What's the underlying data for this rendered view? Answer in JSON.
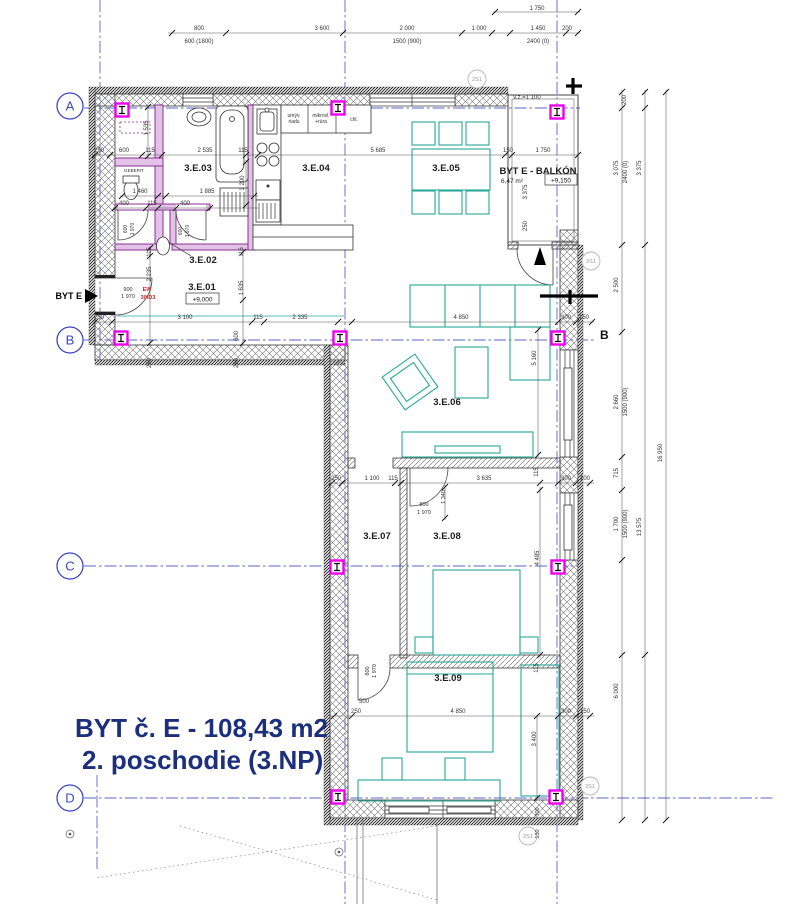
{
  "title": {
    "line1": "BYT č. E  - 108,43 m2",
    "line2": "2. poschodie  (3.NP)"
  },
  "grid": {
    "rows": [
      {
        "label": "A"
      },
      {
        "label": "B"
      },
      {
        "label": "C"
      },
      {
        "label": "D"
      }
    ]
  },
  "rooms": [
    {
      "id": "3.E.01",
      "elevation": "+9,000"
    },
    {
      "id": "3.E.02"
    },
    {
      "id": "3.E.03"
    },
    {
      "id": "3.E.04"
    },
    {
      "id": "3.E.05"
    },
    {
      "id": "3.E.06"
    },
    {
      "id": "3.E.07"
    },
    {
      "id": "3.E.08"
    },
    {
      "id": "3.E.09"
    },
    {
      "id": "BYT E - BALKÓN",
      "area": "6,47 m²",
      "elevation": "+9,150"
    }
  ],
  "markers": {
    "entry_label": "BYT E",
    "section_label": "B",
    "detail_label": "2S1",
    "balcony_note": "v.z.=1 100",
    "fire_rating": [
      "EW",
      "30/D3"
    ],
    "axis_markers": [
      {
        "x": 122,
        "y": 110
      },
      {
        "x": 338,
        "y": 108
      },
      {
        "x": 557,
        "y": 112
      },
      {
        "x": 121,
        "y": 338
      },
      {
        "x": 340,
        "y": 338
      },
      {
        "x": 558,
        "y": 338
      },
      {
        "x": 337,
        "y": 567
      },
      {
        "x": 558,
        "y": 567
      },
      {
        "x": 338,
        "y": 797
      },
      {
        "x": 556,
        "y": 797
      }
    ]
  },
  "colors": {
    "grid": "#3b49c0",
    "furniture": "#2aa79b",
    "marker": "#ee00ee",
    "plumb": "#8a3191",
    "title": "#1b2f7d",
    "fire": "#cc2222"
  },
  "annotations": [
    {
      "n": "dim-top-800",
      "t": "800",
      "x": 199,
      "y": 30
    },
    {
      "n": "dim-top-600-1800",
      "t": "600 (1800)",
      "x": 199,
      "y": 43
    },
    {
      "n": "dim-top-3600",
      "t": "3 600",
      "x": 322,
      "y": 30
    },
    {
      "n": "dim-top-2000",
      "t": "2 000",
      "x": 407,
      "y": 30
    },
    {
      "n": "dim-top-1500-900",
      "t": "1500 (900)",
      "x": 407,
      "y": 43
    },
    {
      "n": "dim-top-1000",
      "t": "1 000",
      "x": 479,
      "y": 30
    },
    {
      "n": "dim-top-1450",
      "t": "1 450",
      "x": 538,
      "y": 30
    },
    {
      "n": "dim-top-2400-0",
      "t": "2400 (0)",
      "x": 538,
      "y": 43
    },
    {
      "n": "dim-top-200",
      "t": "200",
      "x": 567,
      "y": 30
    },
    {
      "n": "dim-top-1750",
      "t": "1 750",
      "x": 537,
      "y": 10
    },
    {
      "n": "dim-bath-250",
      "t": "250",
      "x": 99,
      "y": 152
    },
    {
      "n": "dim-bath-600",
      "t": "600",
      "x": 124,
      "y": 152
    },
    {
      "n": "dim-bath-115a",
      "t": "115",
      "x": 150,
      "y": 152
    },
    {
      "n": "dim-bath-2535",
      "t": "2 535",
      "x": 205,
      "y": 152
    },
    {
      "n": "dim-bath-115b",
      "t": "115",
      "x": 243,
      "y": 152
    },
    {
      "n": "dim-bath-1535",
      "t": "1 535",
      "x": 148,
      "y": 128,
      "r": -90
    },
    {
      "n": "dim-bath-3200",
      "t": "3 200",
      "x": 244,
      "y": 183,
      "r": -90
    },
    {
      "n": "dim-wc-1460",
      "t": "1 460",
      "x": 140,
      "y": 193
    },
    {
      "n": "dim-bath-1885",
      "t": "1 885",
      "x": 207,
      "y": 193
    },
    {
      "n": "dim-wc-400a",
      "t": "400",
      "x": 124,
      "y": 205
    },
    {
      "n": "dim-wc-115",
      "t": "115",
      "x": 152,
      "y": 205
    },
    {
      "n": "dim-wc-400b",
      "t": "400",
      "x": 185,
      "y": 205
    },
    {
      "n": "dim-door-wc-600",
      "t": "600",
      "x": 127,
      "y": 229,
      "r": -90,
      "s": 5
    },
    {
      "n": "dim-door-wc-1970",
      "t": "1 970",
      "x": 134,
      "y": 229,
      "r": -90,
      "s": 5
    },
    {
      "n": "dim-door-302-600",
      "t": "600",
      "x": 182,
      "y": 231,
      "r": -90,
      "s": 5
    },
    {
      "n": "dim-door-302-1970",
      "t": "1 970",
      "x": 189,
      "y": 231,
      "r": -90,
      "s": 5
    },
    {
      "n": "dim-hall-115",
      "t": "115",
      "x": 151,
      "y": 252,
      "r": -90
    },
    {
      "n": "dim-hall-2235",
      "t": "2 235",
      "x": 151,
      "y": 274,
      "r": -90
    },
    {
      "n": "dim-hall-115b",
      "t": "115",
      "x": 243,
      "y": 252,
      "r": -90
    },
    {
      "n": "dim-hall-1635",
      "t": "1 635",
      "x": 243,
      "y": 288,
      "r": -90
    },
    {
      "n": "dim-entry-900",
      "t": "900",
      "x": 128,
      "y": 291,
      "s": 5.5
    },
    {
      "n": "dim-entry-1970",
      "t": "1 970",
      "x": 128,
      "y": 298,
      "s": 5.5
    },
    {
      "n": "fire-ew",
      "t": "EW",
      "x": 147,
      "y": 291,
      "s": 5.5,
      "c": "#cc2222",
      "b": true
    },
    {
      "n": "fire-30d3",
      "t": "30/D3",
      "x": 148,
      "y": 299,
      "s": 5.5,
      "c": "#cc2222",
      "b": true
    },
    {
      "n": "dim-b-250",
      "t": "250",
      "x": 99,
      "y": 319
    },
    {
      "n": "dim-b-3100",
      "t": "3 100",
      "x": 185,
      "y": 319
    },
    {
      "n": "dim-b-115",
      "t": "115",
      "x": 258,
      "y": 319
    },
    {
      "n": "dim-b-2335",
      "t": "2 335",
      "x": 300,
      "y": 319
    },
    {
      "n": "dim-b-4850",
      "t": "4 850",
      "x": 461,
      "y": 319
    },
    {
      "n": "dim-b-300",
      "t": "300",
      "x": 566,
      "y": 319
    },
    {
      "n": "dim-b-150",
      "t": "150",
      "x": 584,
      "y": 319
    },
    {
      "n": "dim-b-250v",
      "t": "250",
      "x": 151,
      "y": 363,
      "r": -90
    },
    {
      "n": "dim-b-600v",
      "t": "600",
      "x": 238,
      "y": 336,
      "r": -90
    },
    {
      "n": "dim-b-250v2",
      "t": "250",
      "x": 238,
      "y": 363,
      "r": -90
    },
    {
      "n": "dim-kit-5685",
      "t": "5 685",
      "x": 378,
      "y": 152
    },
    {
      "n": "dim-balc-150",
      "t": "150",
      "x": 508,
      "y": 152
    },
    {
      "n": "dim-balc-1750",
      "t": "1 750",
      "x": 543,
      "y": 152
    },
    {
      "n": "dim-balc-3375",
      "t": "3 375",
      "x": 527,
      "y": 192,
      "r": -90
    },
    {
      "n": "dim-balc-250",
      "t": "250",
      "x": 527,
      "y": 226,
      "r": -90
    },
    {
      "n": "dim-liv-5160",
      "t": "5 160",
      "x": 536,
      "y": 358,
      "r": -90
    },
    {
      "n": "dim-c-250",
      "t": "250",
      "x": 336,
      "y": 480
    },
    {
      "n": "dim-c-1100",
      "t": "1 100",
      "x": 372,
      "y": 480
    },
    {
      "n": "dim-c-115a",
      "t": "115",
      "x": 393,
      "y": 480
    },
    {
      "n": "dim-c-3635",
      "t": "3 635",
      "x": 484,
      "y": 480
    },
    {
      "n": "dim-c-115v",
      "t": "115",
      "x": 538,
      "y": 472,
      "r": -90
    },
    {
      "n": "dim-c-300",
      "t": "300",
      "x": 566,
      "y": 480
    },
    {
      "n": "dim-c-100",
      "t": "100",
      "x": 585,
      "y": 480
    },
    {
      "n": "dim-door308-800",
      "t": "800",
      "x": 424,
      "y": 506,
      "s": 5.5
    },
    {
      "n": "dim-door308-1970",
      "t": "1 970",
      "x": 424,
      "y": 514,
      "s": 5.5
    },
    {
      "n": "dim-door308-1340",
      "t": "1 340",
      "x": 445,
      "y": 497,
      "r": -90,
      "s": 5.5
    },
    {
      "n": "dim-308-4485",
      "t": "4 485",
      "x": 539,
      "y": 558,
      "r": -90
    },
    {
      "n": "dim-door309-800",
      "t": "800",
      "x": 369,
      "y": 671,
      "r": -90,
      "s": 5.5
    },
    {
      "n": "dim-door309-1970",
      "t": "1 970",
      "x": 376,
      "y": 671,
      "r": -90,
      "s": 5.5
    },
    {
      "n": "dim-309-500",
      "t": "500",
      "x": 364,
      "y": 703
    },
    {
      "n": "dim-309-115",
      "t": "115",
      "x": 538,
      "y": 668,
      "r": -90
    },
    {
      "n": "dim-d-250",
      "t": "250",
      "x": 356,
      "y": 713
    },
    {
      "n": "dim-d-4850",
      "t": "4 850",
      "x": 458,
      "y": 713
    },
    {
      "n": "dim-d-300",
      "t": "300",
      "x": 566,
      "y": 713
    },
    {
      "n": "dim-d-150",
      "t": "150",
      "x": 585,
      "y": 713
    },
    {
      "n": "dim-309-3400",
      "t": "3 400",
      "x": 536,
      "y": 739,
      "r": -90
    },
    {
      "n": "dim-dr-300",
      "t": "300",
      "x": 539,
      "y": 812,
      "r": -90,
      "s": 5.5
    },
    {
      "n": "dim-dr-150",
      "t": "150",
      "x": 539,
      "y": 834,
      "r": -90,
      "s": 5.5
    },
    {
      "n": "dim-r-200",
      "t": "200",
      "x": 626,
      "y": 100,
      "r": -90
    },
    {
      "n": "dim-r-3075",
      "t": "3 075",
      "x": 618,
      "y": 168,
      "r": -90
    },
    {
      "n": "dim-r-2400-0",
      "t": "2400 (0)",
      "x": 627,
      "y": 172,
      "r": -90
    },
    {
      "n": "dim-r-3375",
      "t": "3 375",
      "x": 641,
      "y": 168,
      "r": -90
    },
    {
      "n": "dim-r-2500",
      "t": "2 500",
      "x": 618,
      "y": 285,
      "r": -90
    },
    {
      "n": "dim-r-2660",
      "t": "2 660",
      "x": 618,
      "y": 402,
      "r": -90
    },
    {
      "n": "dim-r-1500-900a",
      "t": "1500 (900)",
      "x": 627,
      "y": 402,
      "r": -90
    },
    {
      "n": "dim-r-16950",
      "t": "16 950",
      "x": 662,
      "y": 453,
      "r": -90
    },
    {
      "n": "dim-r-715",
      "t": "715",
      "x": 618,
      "y": 473,
      "r": -90
    },
    {
      "n": "dim-r-1700",
      "t": "1 700",
      "x": 618,
      "y": 524,
      "r": -90
    },
    {
      "n": "dim-r-1500-900b",
      "t": "1500 (900)",
      "x": 627,
      "y": 524,
      "r": -90
    },
    {
      "n": "dim-r-13575",
      "t": "13 575",
      "x": 641,
      "y": 527,
      "r": -90
    },
    {
      "n": "dim-r-6000",
      "t": "6 000",
      "x": 618,
      "y": 691,
      "r": -90
    },
    {
      "n": "note-vz",
      "t": "v.z.=1 100",
      "x": 527,
      "y": 99
    },
    {
      "n": "kitchen-dishwasher-1",
      "t": "umýv.",
      "x": 294,
      "y": 117,
      "s": 5
    },
    {
      "n": "kitchen-dishwasher-2",
      "t": "riadu",
      "x": 294,
      "y": 123,
      "s": 5
    },
    {
      "n": "kitchen-micro-1",
      "t": "mikrovl.",
      "x": 321,
      "y": 117,
      "s": 5
    },
    {
      "n": "kitchen-micro-2",
      "t": "+rúra",
      "x": 321,
      "y": 123,
      "s": 5
    },
    {
      "n": "kitchen-fridge",
      "t": "chl.",
      "x": 354,
      "y": 121,
      "s": 5
    },
    {
      "n": "fixture-geberit",
      "t": "GEBERIT",
      "x": 134,
      "y": 172,
      "s": 4.5
    },
    {
      "n": "detail-2s1-a",
      "t": "2S1",
      "x": 477,
      "y": 81,
      "s": 5.5,
      "c": "#999999"
    },
    {
      "n": "detail-2s1-b",
      "t": "2S1",
      "x": 591,
      "y": 263,
      "s": 5.5,
      "c": "#999999"
    },
    {
      "n": "detail-2s1-c",
      "t": "2S1",
      "x": 590,
      "y": 788,
      "s": 5.5,
      "c": "#999999"
    },
    {
      "n": "detail-2s1-d",
      "t": "2S1",
      "x": 528,
      "y": 838,
      "s": 5.5,
      "c": "#999999"
    }
  ]
}
